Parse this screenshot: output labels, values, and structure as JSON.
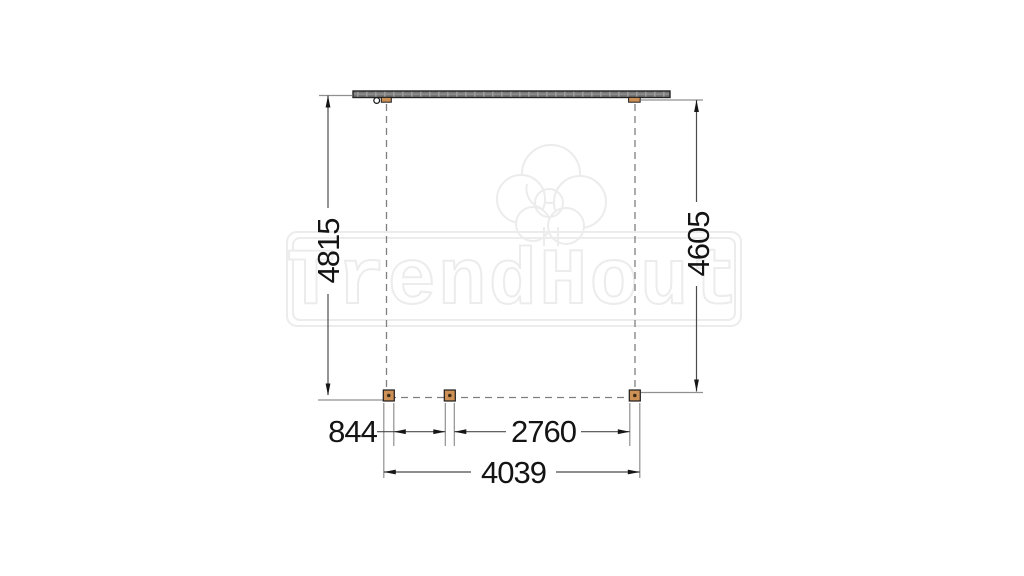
{
  "watermark": {
    "brand": "TrendHout",
    "logo": "tree-cloud-icon",
    "outline_color": "#ececec"
  },
  "drawing": {
    "type": "plan-view construction drawing (veranda / canopy top view)",
    "labels": {
      "side_left": "4815",
      "side_right": "4605",
      "bottom_left": "844",
      "bottom_middle": "2760",
      "bottom_total": "4039"
    },
    "colors": {
      "post_fill": "#cd9055",
      "beam_fill": "#757575",
      "dim_line": "#4b4b4b",
      "extension_line": "#909090",
      "dashed_line": "#7f7f7f",
      "text": "#141414"
    }
  }
}
